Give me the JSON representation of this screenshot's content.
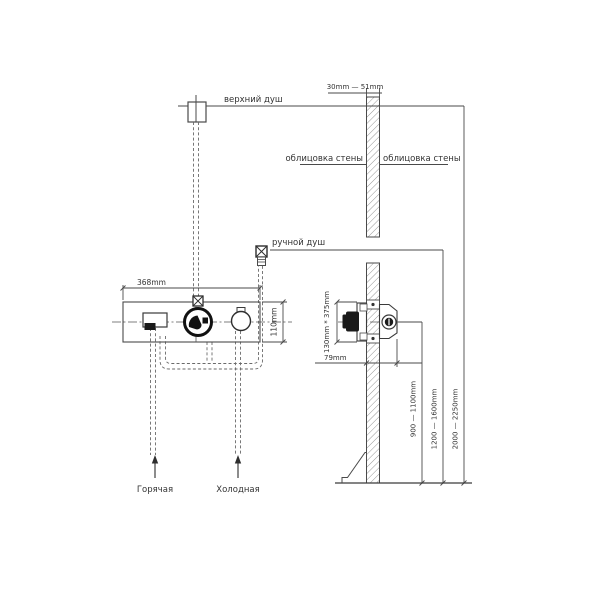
{
  "labels": {
    "top_shower": "верхний душ",
    "hand_shower": "ручной душ",
    "wall_cladding_left": "облицовка стены",
    "wall_cladding_right": "облицовка стены",
    "hot_supply": "Горячая",
    "cold_supply": "Холодная"
  },
  "dimensions": {
    "wall_thickness_range": "30mm — 51mm",
    "mixer_width": "368mm",
    "mixer_height": "110mm",
    "rough_in_plate": "130mm * 375mm",
    "rough_in_depth": "79mm",
    "mixer_mounting_height": "900 — 1100mm",
    "hand_shower_mounting_height": "1200 — 1600mm",
    "overhead_shower_mounting_height": "2000 — 2250mm"
  },
  "colors": {
    "line": "#4a4a4a",
    "pipe": "#6a6a6a",
    "text": "#333333",
    "background": "#ffffff"
  }
}
